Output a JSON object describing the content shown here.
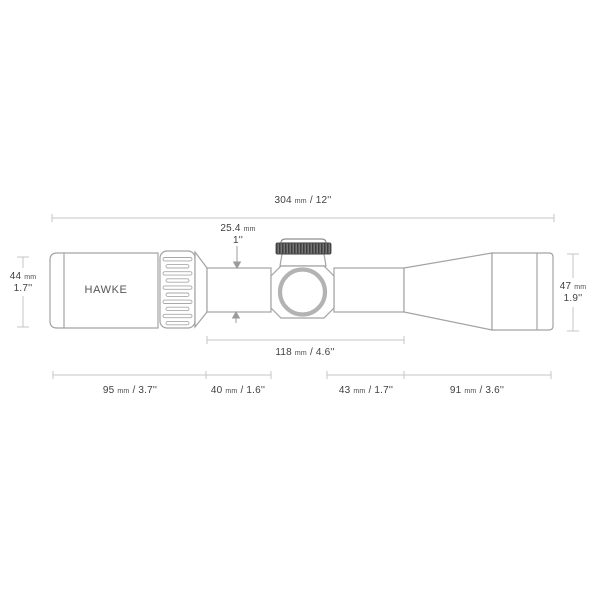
{
  "drawing": {
    "brand": "HAWKE"
  },
  "dimensions": {
    "overall_length": {
      "metric": "304",
      "unit": "mm",
      "imperial": "12''",
      "stacked": false
    },
    "tube_diameter": {
      "metric": "25.4",
      "unit": "mm",
      "imperial": "1''",
      "stacked": true
    },
    "eyepiece_diameter": {
      "metric": "44",
      "unit": "mm",
      "imperial": "1.7''",
      "stacked": true
    },
    "objective_diameter": {
      "metric": "47",
      "unit": "mm",
      "imperial": "1.9''",
      "stacked": true
    },
    "mounting_length": {
      "metric": "118",
      "unit": "mm",
      "imperial": "4.6''",
      "stacked": false
    },
    "eyepiece_section": {
      "metric": "95",
      "unit": "mm",
      "imperial": "3.7''",
      "stacked": false
    },
    "rear_tube_section": {
      "metric": "40",
      "unit": "mm",
      "imperial": "1.6''",
      "stacked": false
    },
    "front_tube_section": {
      "metric": "43",
      "unit": "mm",
      "imperial": "1.7''",
      "stacked": false
    },
    "objective_section": {
      "metric": "91",
      "unit": "mm",
      "imperial": "3.6''",
      "stacked": false
    }
  },
  "colors": {
    "background": "#ffffff",
    "outline": "#a3a3a3",
    "dim_line": "#c6c6c6",
    "text": "#3f3f3f",
    "turret_cap_dark": "#4a4a4a",
    "ring_gray": "#b3b3b3"
  }
}
